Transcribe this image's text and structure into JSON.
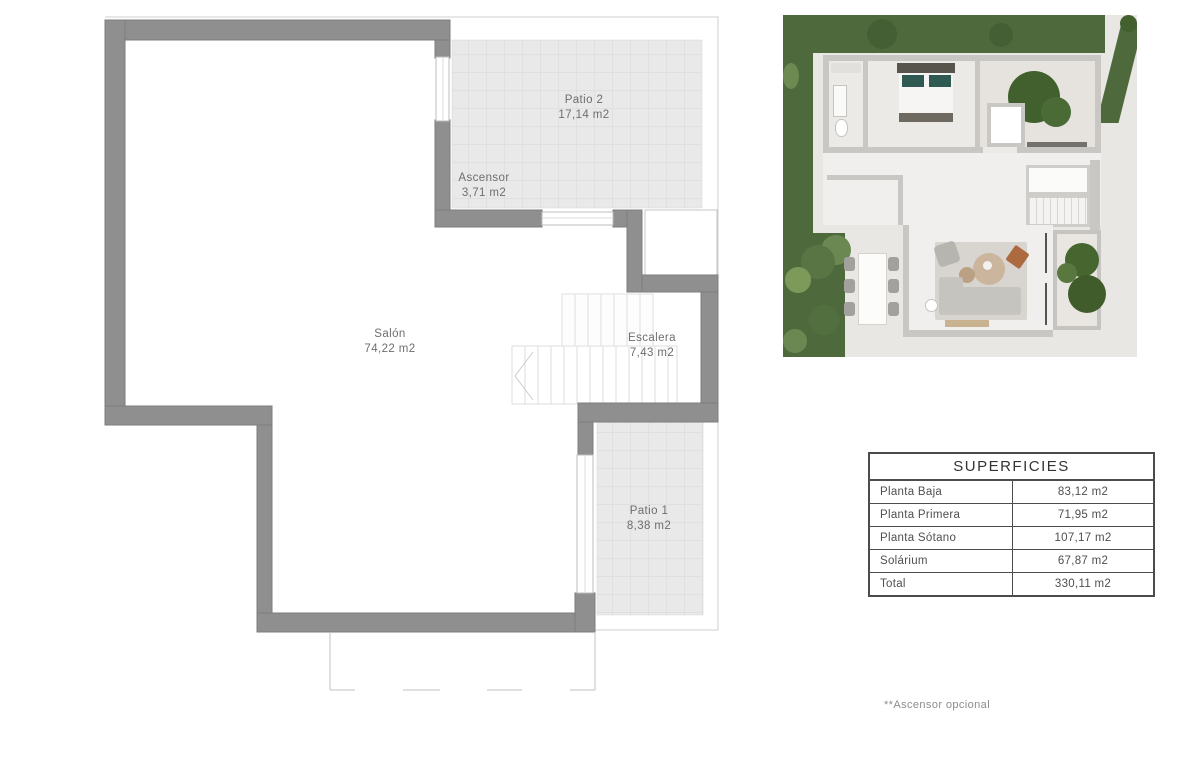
{
  "plan": {
    "rooms": [
      {
        "name": "Patio 2",
        "area": "17,14 m2"
      },
      {
        "name": "Ascensor",
        "area": "3,71 m2"
      },
      {
        "name": "Salón",
        "area": "74,22 m2"
      },
      {
        "name": "Escalera",
        "area": "7,43 m2"
      },
      {
        "name": "Patio 1",
        "area": "8,38 m2"
      }
    ]
  },
  "table": {
    "title": "SUPERFICIES",
    "rows": [
      {
        "label": "Planta Baja",
        "value": "83,12 m2"
      },
      {
        "label": "Planta Primera",
        "value": "71,95 m2"
      },
      {
        "label": "Planta Sótano",
        "value": "107,17 m2"
      },
      {
        "label": "Solárium",
        "value": "67,87 m2"
      },
      {
        "label": "Total",
        "value": "330,11 m2"
      }
    ]
  },
  "footnote": "**Ascensor opcional",
  "colors": {
    "wall_gray": "#8f8f8f",
    "patio_hatch": "#e9e9e9",
    "grass_green": "#4e6a3d",
    "label_text": "#6e6e6e",
    "table_border": "#4c4c4c"
  }
}
